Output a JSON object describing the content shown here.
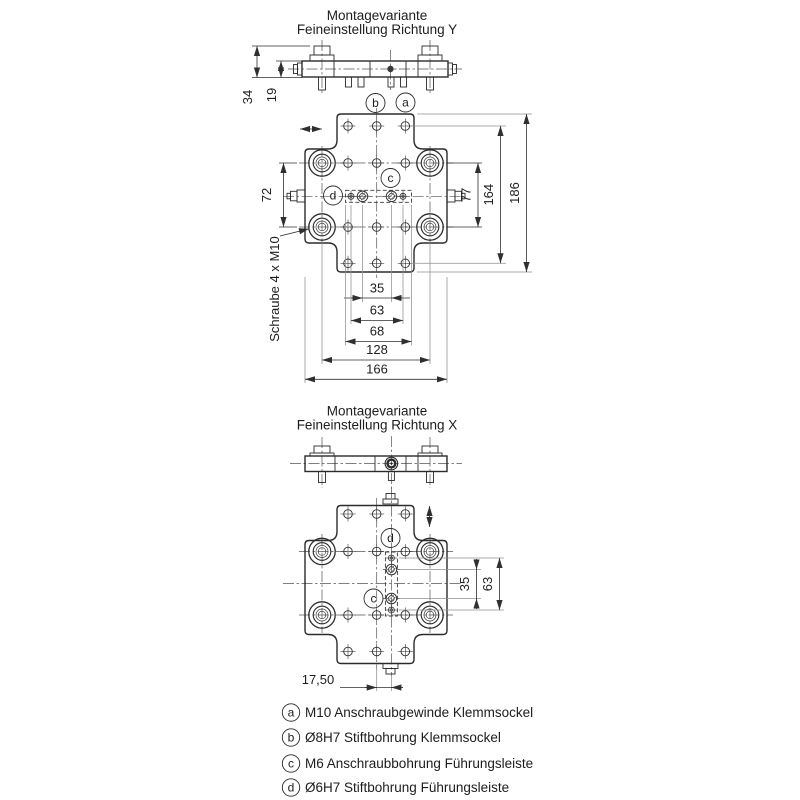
{
  "titles": {
    "variant_y_line1": "Montagevariante",
    "variant_y_line2": "Feineinstellung Richtung Y",
    "variant_x_line1": "Montagevariante",
    "variant_x_line2": "Feineinstellung Richtung X"
  },
  "view_y": {
    "dim_34": "34",
    "dim_19": "19",
    "dim_72": "72",
    "dim_77": "77",
    "dim_164": "164",
    "dim_186": "186",
    "dim_35": "35",
    "dim_63": "63",
    "dim_68": "68",
    "dim_128": "128",
    "dim_166": "166",
    "label_a": "a",
    "label_b": "b",
    "label_c": "c",
    "label_d": "d",
    "screw_note": "Schraube 4 x M10"
  },
  "view_x": {
    "dim_35": "35",
    "dim_63": "63",
    "dim_17_50": "17,50",
    "label_c": "c",
    "label_d": "d"
  },
  "legend": [
    {
      "key": "a",
      "text": "M10 Anschraubgewinde Klemmsockel"
    },
    {
      "key": "b",
      "text": "Ø8H7 Stiftbohrung Klemmsockel"
    },
    {
      "key": "c",
      "text": "M6 Anschraubbohrung Führungsleiste"
    },
    {
      "key": "d",
      "text": "Ø6H7 Stiftbohrung Führungsleiste"
    }
  ],
  "colors": {
    "line": "#2b2b2b",
    "gray_line": "#8f8f8f",
    "background": "#ffffff"
  }
}
